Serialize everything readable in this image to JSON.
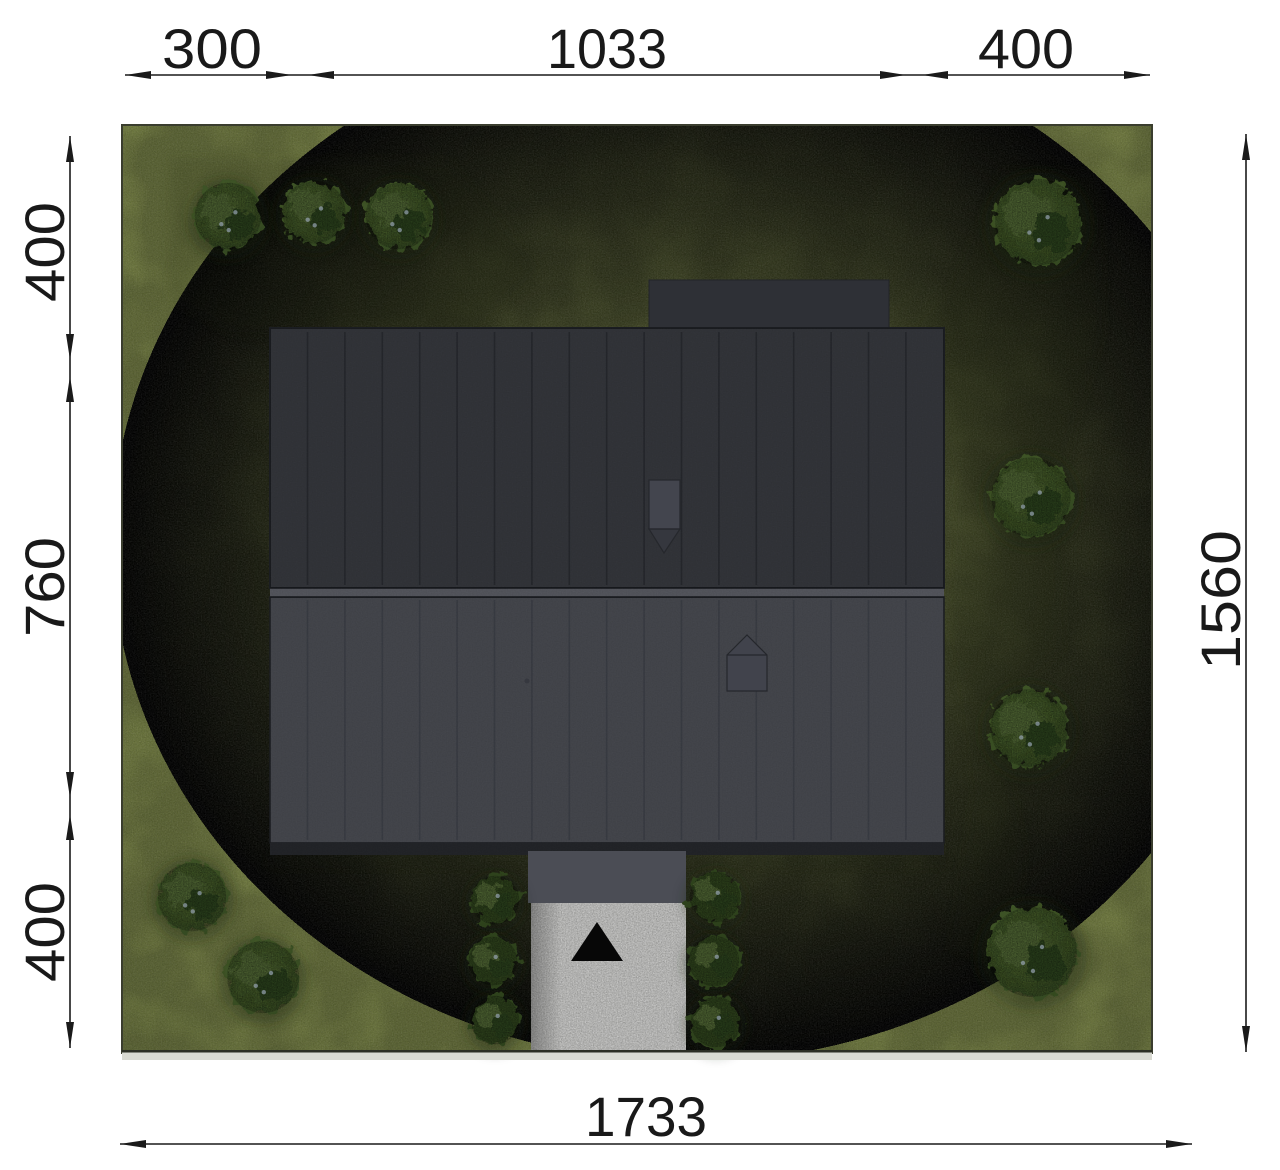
{
  "drawing": {
    "type": "architectural-site-plan",
    "units": "cm",
    "dimensions": {
      "top": [
        "300",
        "1033",
        "400"
      ],
      "left": [
        "400",
        "760",
        "400"
      ],
      "right": [
        "1560"
      ],
      "bottom": [
        "1733"
      ]
    },
    "colors": {
      "grass": "#7b8747",
      "grass_shadow": "#1a2110",
      "tree_foliage": "#3c5125",
      "roof_upper": "#33353a",
      "roof_lower": "#45474d",
      "annex_roof": "#2e3036",
      "ridge": "#55575e",
      "terrace": "#4b4d55",
      "paving": "#b6b6b4",
      "north_marker": "#070707",
      "dimension_ink": "#191919",
      "curb_strip": "#d9dad2"
    },
    "trees": [
      {
        "x": 228,
        "y": 216,
        "r": 37
      },
      {
        "x": 314,
        "y": 212,
        "r": 35
      },
      {
        "x": 399,
        "y": 216,
        "r": 37
      },
      {
        "x": 1038,
        "y": 222,
        "r": 48
      },
      {
        "x": 1031,
        "y": 497,
        "r": 44
      },
      {
        "x": 1029,
        "y": 728,
        "r": 43
      },
      {
        "x": 1032,
        "y": 952,
        "r": 50
      },
      {
        "x": 192,
        "y": 897,
        "r": 38
      },
      {
        "x": 263,
        "y": 977,
        "r": 40
      }
    ],
    "bushes": [
      {
        "x": 495,
        "y": 900,
        "r": 27
      },
      {
        "x": 493,
        "y": 961,
        "r": 27
      },
      {
        "x": 495,
        "y": 1020,
        "r": 27
      },
      {
        "x": 715,
        "y": 897,
        "r": 28
      },
      {
        "x": 714,
        "y": 961,
        "r": 28
      },
      {
        "x": 716,
        "y": 1022,
        "r": 28
      }
    ]
  }
}
